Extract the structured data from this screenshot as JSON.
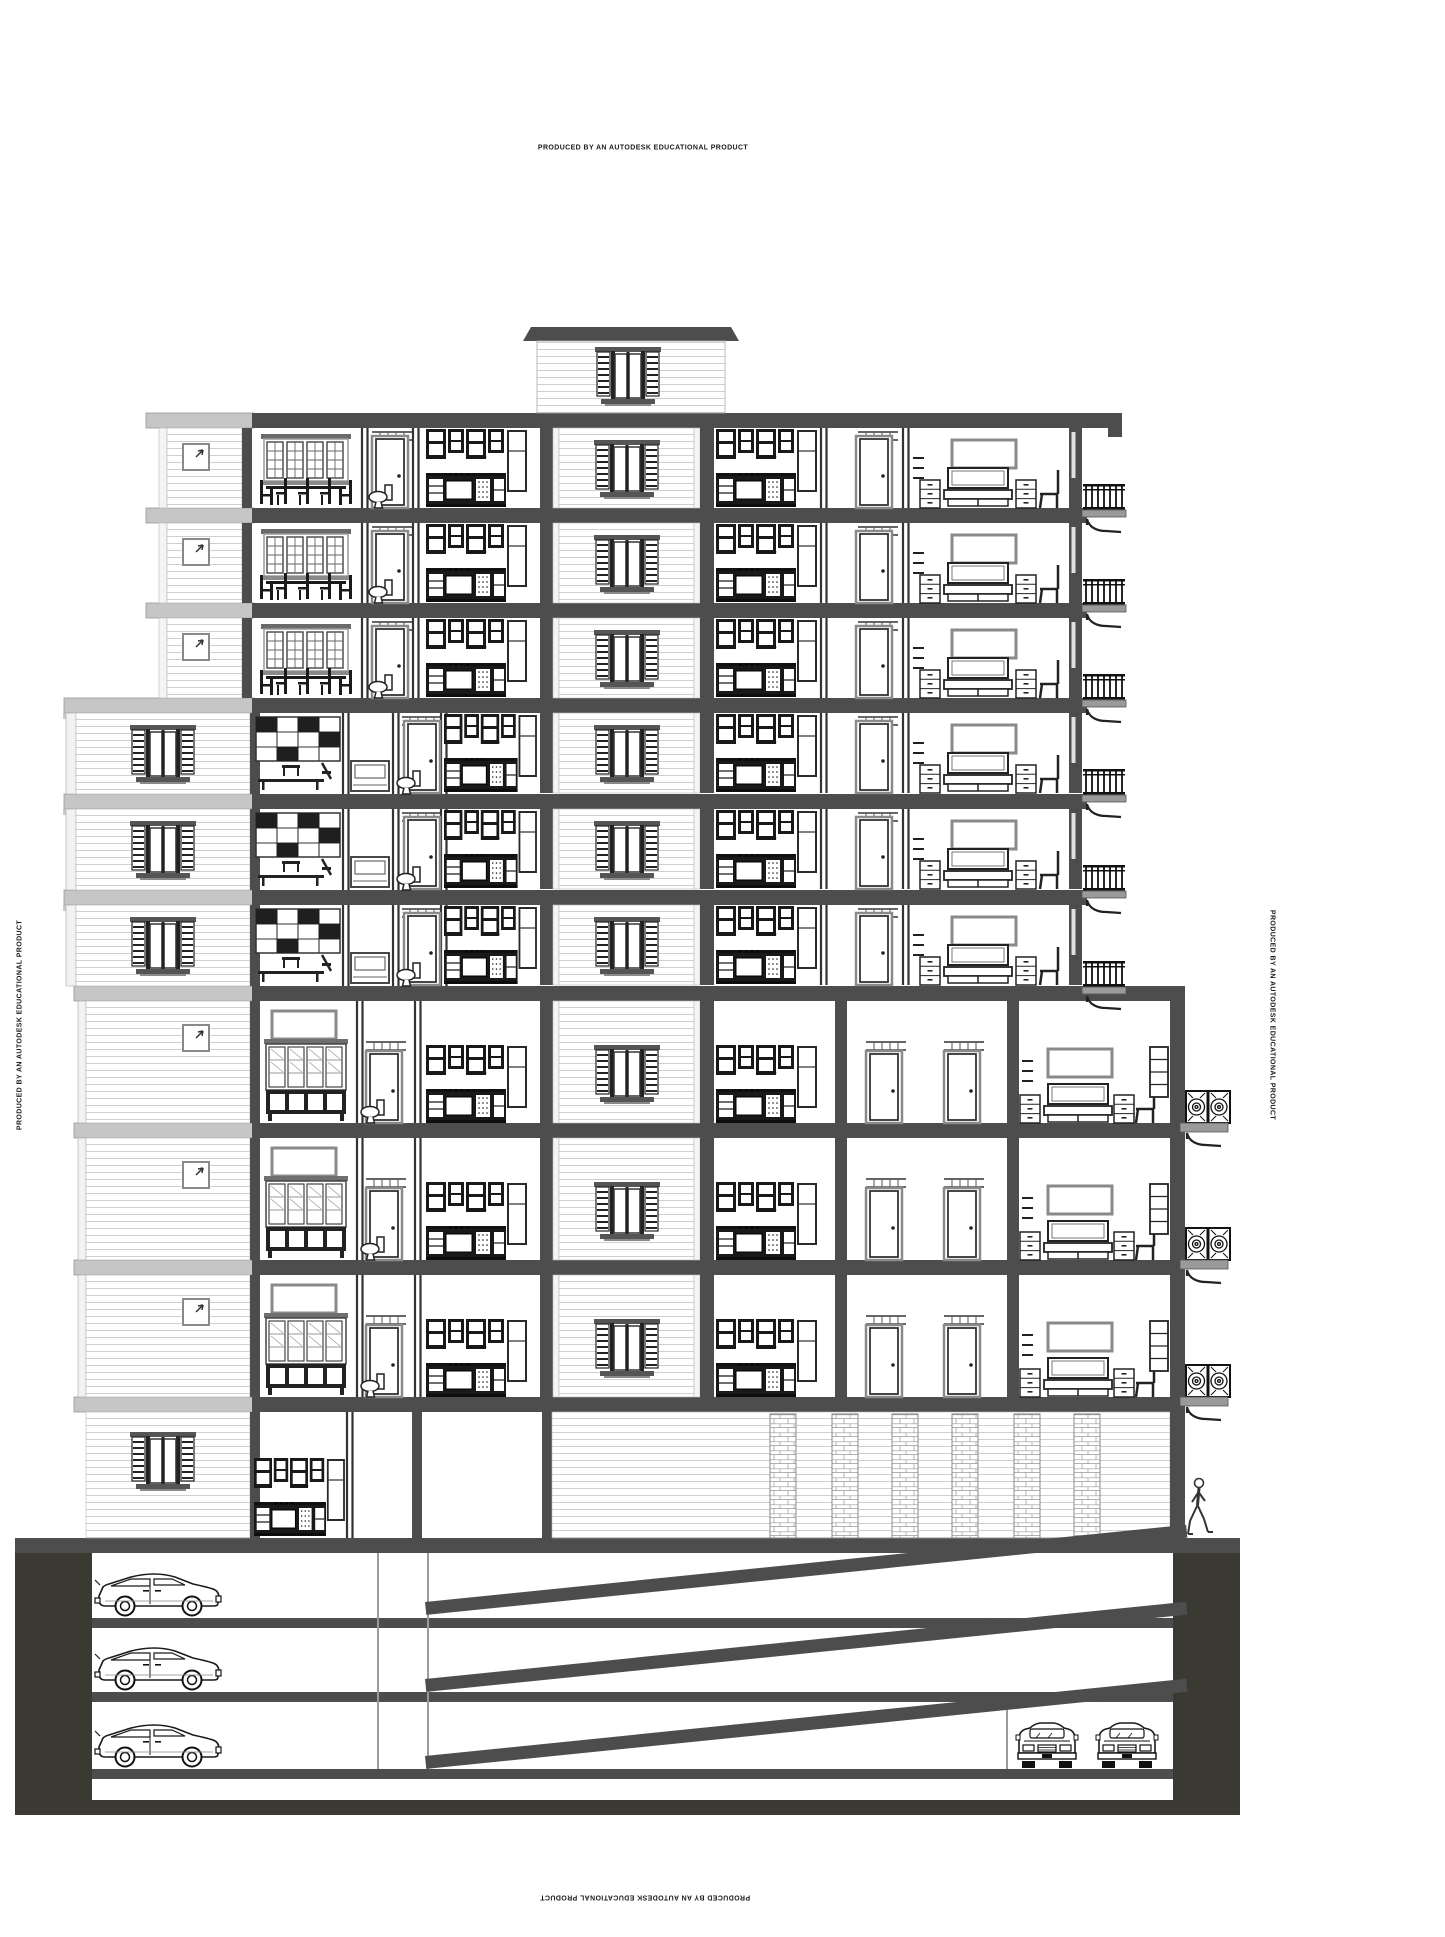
{
  "watermark": {
    "text": "PRODUCED BY AN AUTODESK EDUCATIONAL PRODUCT",
    "positions": [
      "top",
      "left-edge-rotated",
      "right-edge-rotated",
      "bottom-inverted"
    ]
  },
  "drawing": {
    "kind": "architectural-building-cross-section",
    "building": {
      "roof_bulkhead": {
        "feature": "shuttered-window"
      },
      "floor_stack": [
        {
          "type": "upper",
          "rooms": [
            "dining room",
            "bathroom",
            "kitchen",
            "stair shaft",
            "kitchen",
            "hall",
            "bedroom",
            "balcony"
          ]
        },
        {
          "type": "upper",
          "rooms": [
            "dining room",
            "bathroom",
            "kitchen",
            "stair shaft",
            "kitchen",
            "hall",
            "bedroom",
            "balcony"
          ]
        },
        {
          "type": "upper",
          "rooms": [
            "dining room",
            "bathroom",
            "kitchen",
            "stair shaft",
            "kitchen",
            "hall",
            "bedroom",
            "balcony"
          ]
        },
        {
          "type": "middle",
          "rooms": [
            "closet wall",
            "dressing",
            "bathroom",
            "kitchen",
            "stair shaft",
            "kitchen",
            "hall",
            "bedroom",
            "balcony"
          ]
        },
        {
          "type": "middle",
          "rooms": [
            "closet wall",
            "dressing",
            "bathroom",
            "kitchen",
            "stair shaft",
            "kitchen",
            "hall",
            "bedroom",
            "balcony"
          ]
        },
        {
          "type": "middle",
          "rooms": [
            "closet wall",
            "dressing",
            "bathroom",
            "kitchen",
            "stair shaft",
            "kitchen",
            "hall",
            "bedroom",
            "balcony"
          ]
        },
        {
          "type": "lower",
          "rooms": [
            "living room with china cabinet",
            "bathroom",
            "kitchen",
            "stair shaft",
            "kitchen",
            "hall",
            "bedroom",
            "balcony"
          ]
        },
        {
          "type": "lower",
          "rooms": [
            "living room with china cabinet",
            "bathroom",
            "kitchen",
            "stair shaft",
            "kitchen",
            "hall",
            "bedroom",
            "balcony"
          ]
        },
        {
          "type": "lower",
          "rooms": [
            "living room with china cabinet",
            "bathroom",
            "kitchen",
            "stair shaft",
            "kitchen",
            "hall",
            "bedroom",
            "balcony"
          ]
        },
        {
          "type": "ground",
          "rooms": [
            "kitchen",
            "lobby",
            "garage front with brick piers"
          ]
        }
      ]
    },
    "basement": {
      "levels": 3,
      "side_cars": 3,
      "front_cars": 2,
      "ramps": 3
    },
    "site": {
      "pedestrians": 1
    }
  },
  "colors": {
    "paper": "#ffffff",
    "structure_gray": "#4d4d4d",
    "ground_fill": "#3a3a33",
    "cornice_gray": "#c6c6c6",
    "siding_line": "#cfcfcf",
    "ink": "#1b1b1b"
  }
}
